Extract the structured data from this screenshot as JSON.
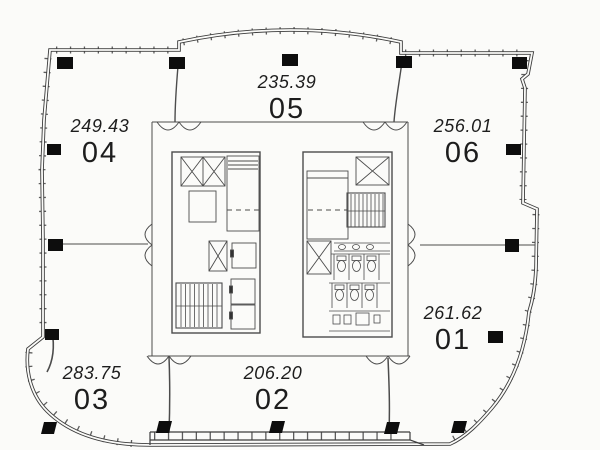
{
  "drawing_title": "floor-plan",
  "units": [
    {
      "number": "04",
      "area": "249.43"
    },
    {
      "number": "05",
      "area": "235.39"
    },
    {
      "number": "06",
      "area": "256.01"
    },
    {
      "number": "01",
      "area": "261.62"
    },
    {
      "number": "02",
      "area": "206.20"
    },
    {
      "number": "03",
      "area": "283.75"
    }
  ],
  "colors": {
    "paper": "#fbfbf9",
    "line": "#3c3c3c",
    "column": "#0d0d0d",
    "text": "#1d1d1d"
  }
}
